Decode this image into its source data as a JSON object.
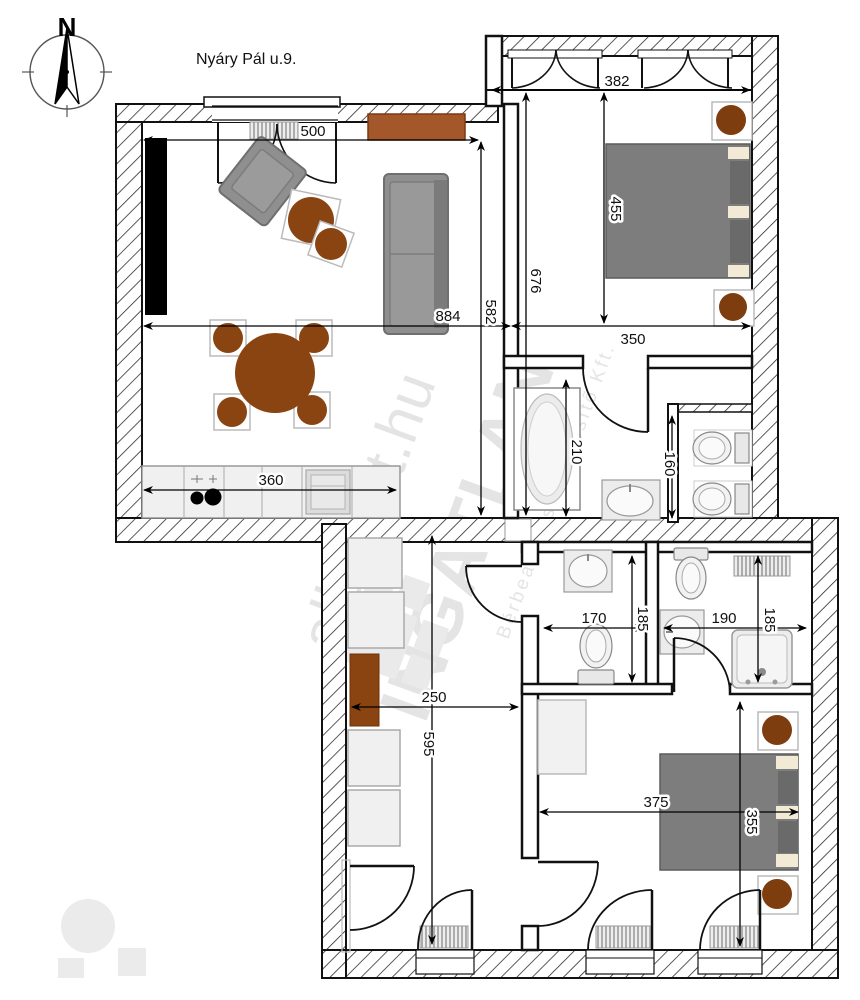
{
  "title": "Nyáry Pál u.9.",
  "compass": {
    "north": "N"
  },
  "watermark": {
    "brand_top": "alberlet.hu",
    "brand_main": "INGATLAN",
    "brand_sub": "Bérbeadó és Értékesítő Kft."
  },
  "dims": {
    "living_window": "500",
    "bedroom1_window": "382",
    "bedroom1_width": "455",
    "right_wing_depth": "676",
    "living_length": "884",
    "living_depth": "582",
    "bedroom1_inner": "350",
    "bathtub": "210",
    "wc_niche": "160",
    "kitchen_counter": "360",
    "wc_width": "170",
    "wc_depth": "185",
    "shower_width": "190",
    "shower_depth": "185",
    "hallway_width": "250",
    "hallway_length": "595",
    "bedroom2_width": "375",
    "bedroom2_depth": "355"
  },
  "colors": {
    "wall_line": "#111111",
    "furniture_brown": "#8a4412",
    "sideboard_brown": "#a3572a",
    "bed_gray": "#7d7d7d",
    "pillow_cream": "#f3ead6",
    "watermark_gray": "#c9c9c9"
  }
}
